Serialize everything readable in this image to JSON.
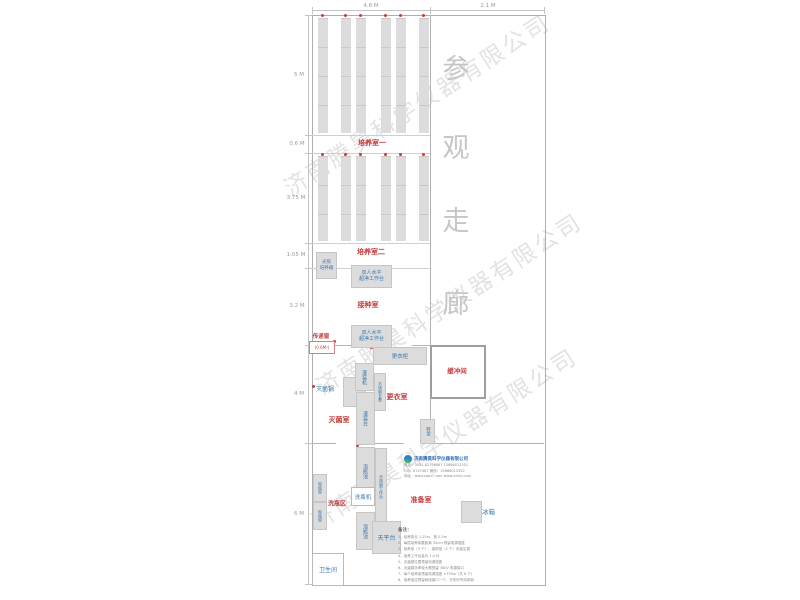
{
  "watermark": {
    "text": "济南腾昊科学仪器有限公司"
  },
  "dimensions": {
    "top": {
      "width_left": "4.8 M",
      "width_right": "2.1 M"
    },
    "left": {
      "d1": "5 M",
      "d2": "0.6 M",
      "d3": "3.75 M",
      "d4": "1.05 M",
      "d5": "3.2 M",
      "d6": "4 M",
      "d7": "6 M"
    }
  },
  "corridor": {
    "c1": "参",
    "c2": "观",
    "c3": "走",
    "c4": "廊"
  },
  "rooms": {
    "culture1": "培养室一",
    "culture2": "培养室二",
    "inoculation": "接种室",
    "sterilization": "灭菌室",
    "changing": "更衣室",
    "buffer": "缓冲间",
    "prep": "准备室",
    "washing": "洗瓶区",
    "toilet": "卫生间"
  },
  "equipment": {
    "light_incubator": "光照\n培养箱",
    "clean_bench_1": "双人水平\n超净工作台",
    "clean_bench_2": "双人水平\n超净工作台",
    "pass_window": "传递窗",
    "pass_window_size": "(0.6M²)",
    "wardrobe": "更衣柜",
    "sterilizer": "灭菌锅",
    "filling_machine": "灌装机",
    "steel_bench": "不锈钢长凳",
    "filling_table": "灌装台",
    "shoe_rack": "鞋架",
    "soak_pool_1": "泡瓶池",
    "soak_pool_2": "泡瓶池",
    "steel_worktable": "不锈钢工作台",
    "bottle_washer": "洗瓶机",
    "drying_rack_1": "晾瓶架",
    "drying_rack_2": "晾瓶架",
    "balance_table": "天平台",
    "fridge": "冰箱"
  },
  "company": {
    "name": "济南腾昊科学仪器有限公司",
    "phone_line": "电话：0531-82796867  15866013352",
    "qq_line": "QQ：6747467  微信：15866013352",
    "web_line": "网址：www.sqwl7.com  www.cnhkj.com"
  },
  "notes": {
    "title": "备注：",
    "items": [
      "1、培养架长 1.25m，宽 0.5m",
      "2、每层培养架要距离 30cm 预留电源插座",
      "3、培养室（3 个）、接种室（2 个）安装空调",
      "4、培养工作台高为 1.0 M",
      "5、灭菌锅位置预留电源插座",
      "6、灭菌锅功率较大需预留 380V 电源接口",
      "7、每个培养架预留电源插座 ×750w（共 8 个）",
      "8、培养室应预留网线接口一个，天热时专用风扇."
    ]
  },
  "colors": {
    "label_red": "#c23b3b",
    "label_blue": "#3a77ad",
    "outlet_red": "#d23a2e",
    "shelf_gray": "#dcdcdc",
    "wall_gray": "#b4b4b4",
    "corridor_text_gray": "#c6c6c6"
  }
}
